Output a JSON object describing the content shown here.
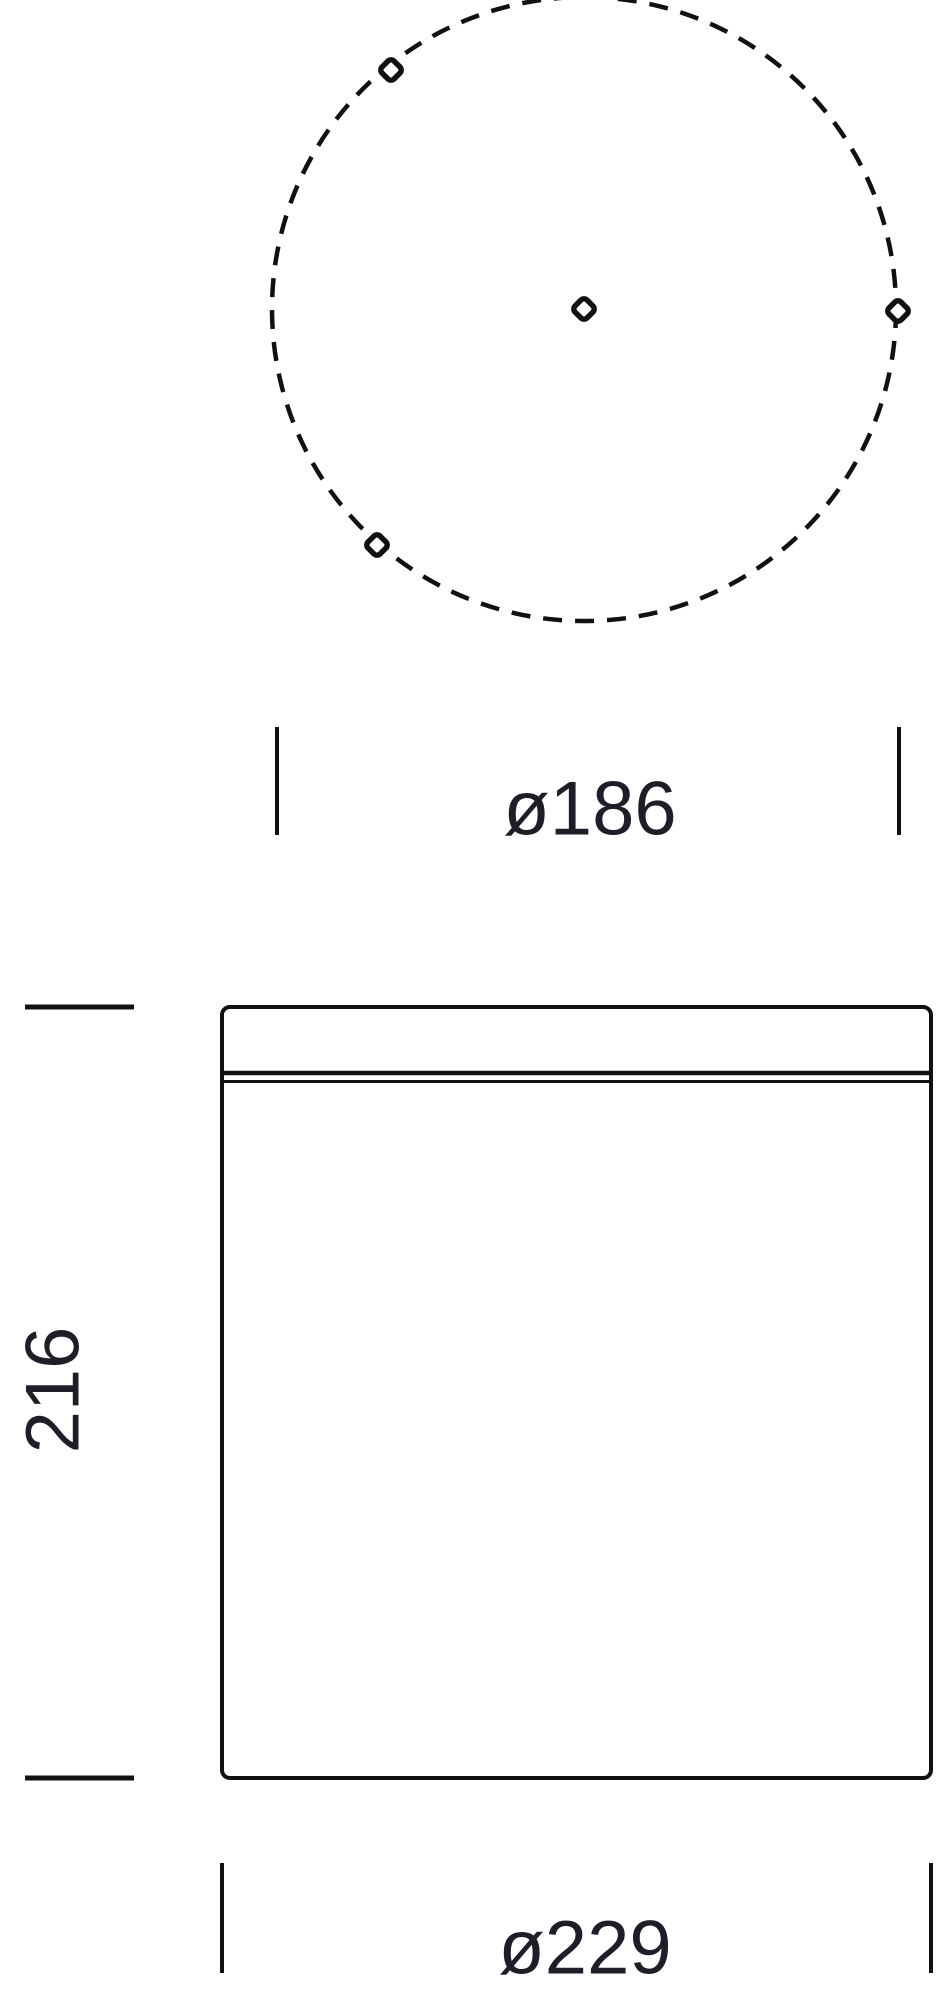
{
  "page": {
    "background": "#ffffff"
  },
  "drawing": {
    "type": "technical-dimension-drawing",
    "views": {
      "top_view": {
        "circle_style": "dashed",
        "markers": [
          "center-hole-marker",
          "mounting-hole-marker-upper-left",
          "mounting-hole-marker-right",
          "mounting-hole-marker-lower-left"
        ]
      },
      "front_view": {
        "shape": "cylinder-body-with-top-seam"
      }
    },
    "dimensions": {
      "top_diameter": {
        "label": "ø186",
        "value": 186
      },
      "height": {
        "label": "216",
        "value": 216
      },
      "body_diameter": {
        "label": "ø229",
        "value": 229
      }
    },
    "colors": {
      "line": "#111111",
      "text": "#1e1e28",
      "background": "#ffffff"
    }
  }
}
